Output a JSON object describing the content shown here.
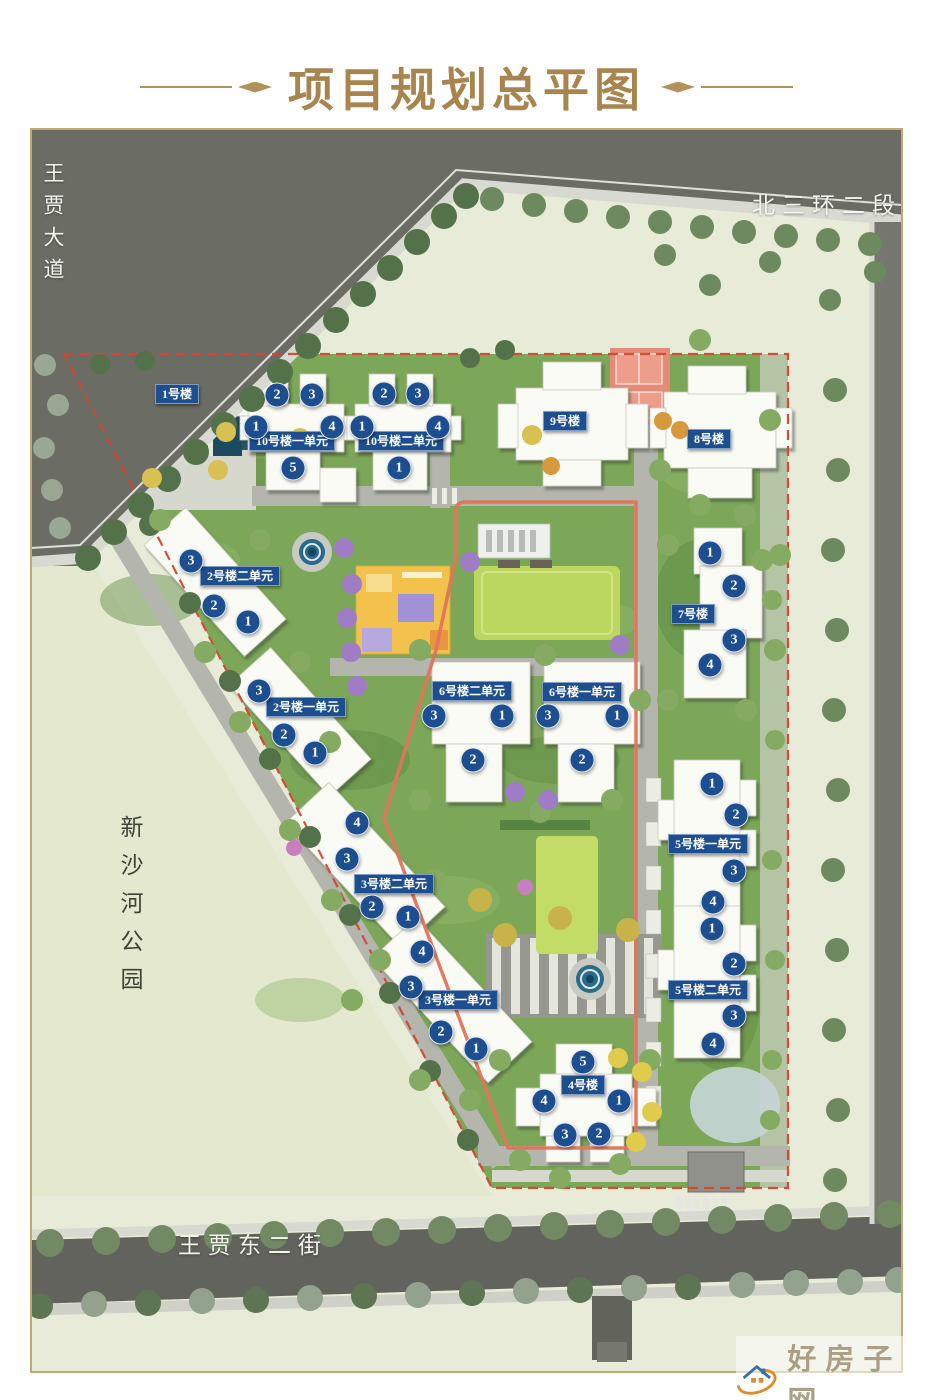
{
  "title": "项目规划总平图",
  "streets": {
    "left": "王贾大道",
    "top_right": "北三环二段",
    "bottom": "王贾东二街",
    "park": "新沙河公园"
  },
  "map": {
    "buildings": [
      {
        "label": "1号楼",
        "x": 177,
        "y": 394,
        "units": []
      },
      {
        "label": "10号楼一单元",
        "x": 292,
        "y": 441,
        "units": [
          {
            "n": "2",
            "x": 277,
            "y": 395
          },
          {
            "n": "3",
            "x": 312,
            "y": 395
          },
          {
            "n": "1",
            "x": 256,
            "y": 427
          },
          {
            "n": "4",
            "x": 332,
            "y": 427
          },
          {
            "n": "5",
            "x": 293,
            "y": 468
          }
        ]
      },
      {
        "label": "10号楼二单元",
        "x": 401,
        "y": 441,
        "units": [
          {
            "n": "2",
            "x": 384,
            "y": 394
          },
          {
            "n": "3",
            "x": 418,
            "y": 394
          },
          {
            "n": "1",
            "x": 362,
            "y": 427
          },
          {
            "n": "4",
            "x": 438,
            "y": 427
          },
          {
            "n": "1",
            "x": 399,
            "y": 468
          }
        ]
      },
      {
        "label": "9号楼",
        "x": 565,
        "y": 421,
        "units": []
      },
      {
        "label": "8号楼",
        "x": 709,
        "y": 439,
        "units": []
      },
      {
        "label": "2号楼二单元",
        "x": 240,
        "y": 576,
        "units": [
          {
            "n": "3",
            "x": 191,
            "y": 561
          },
          {
            "n": "2",
            "x": 214,
            "y": 606
          },
          {
            "n": "1",
            "x": 248,
            "y": 622
          }
        ]
      },
      {
        "label": "2号楼一单元",
        "x": 306,
        "y": 707,
        "units": [
          {
            "n": "3",
            "x": 259,
            "y": 691
          },
          {
            "n": "2",
            "x": 284,
            "y": 735
          },
          {
            "n": "1",
            "x": 315,
            "y": 753
          }
        ]
      },
      {
        "label": "6号楼二单元",
        "x": 472,
        "y": 691,
        "units": [
          {
            "n": "3",
            "x": 434,
            "y": 716
          },
          {
            "n": "1",
            "x": 502,
            "y": 716
          },
          {
            "n": "2",
            "x": 473,
            "y": 760
          }
        ]
      },
      {
        "label": "6号楼一单元",
        "x": 582,
        "y": 692,
        "units": [
          {
            "n": "3",
            "x": 548,
            "y": 716
          },
          {
            "n": "1",
            "x": 617,
            "y": 716
          },
          {
            "n": "2",
            "x": 582,
            "y": 760
          }
        ]
      },
      {
        "label": "7号楼",
        "x": 693,
        "y": 614,
        "units": [
          {
            "n": "1",
            "x": 710,
            "y": 553
          },
          {
            "n": "2",
            "x": 734,
            "y": 586
          },
          {
            "n": "3",
            "x": 734,
            "y": 640
          },
          {
            "n": "4",
            "x": 710,
            "y": 665
          }
        ]
      },
      {
        "label": "3号楼二单元",
        "x": 394,
        "y": 884,
        "units": [
          {
            "n": "4",
            "x": 357,
            "y": 823
          },
          {
            "n": "3",
            "x": 347,
            "y": 859
          },
          {
            "n": "2",
            "x": 372,
            "y": 907
          },
          {
            "n": "1",
            "x": 408,
            "y": 917
          }
        ]
      },
      {
        "label": "3号楼一单元",
        "x": 458,
        "y": 1000,
        "units": [
          {
            "n": "4",
            "x": 422,
            "y": 952
          },
          {
            "n": "3",
            "x": 411,
            "y": 987
          },
          {
            "n": "2",
            "x": 441,
            "y": 1032
          },
          {
            "n": "1",
            "x": 476,
            "y": 1049
          }
        ]
      },
      {
        "label": "5号楼一单元",
        "x": 708,
        "y": 844,
        "units": [
          {
            "n": "1",
            "x": 712,
            "y": 784
          },
          {
            "n": "2",
            "x": 736,
            "y": 815
          },
          {
            "n": "3",
            "x": 734,
            "y": 871
          },
          {
            "n": "4",
            "x": 713,
            "y": 902
          }
        ]
      },
      {
        "label": "5号楼二单元",
        "x": 708,
        "y": 990,
        "units": [
          {
            "n": "1",
            "x": 712,
            "y": 929
          },
          {
            "n": "2",
            "x": 734,
            "y": 964
          },
          {
            "n": "3",
            "x": 734,
            "y": 1016
          },
          {
            "n": "4",
            "x": 713,
            "y": 1044
          }
        ]
      },
      {
        "label": "4号楼",
        "x": 583,
        "y": 1085,
        "units": [
          {
            "n": "5",
            "x": 583,
            "y": 1062
          },
          {
            "n": "4",
            "x": 544,
            "y": 1101
          },
          {
            "n": "1",
            "x": 619,
            "y": 1101
          },
          {
            "n": "3",
            "x": 565,
            "y": 1135
          },
          {
            "n": "2",
            "x": 599,
            "y": 1134
          }
        ]
      }
    ]
  },
  "watermark": {
    "site_name": "好房子网",
    "url": "www.hfangziwang.com"
  },
  "colors": {
    "title_gold": "#a8854e",
    "label_blue": "#1d4e8f",
    "boundary_red": "#d6452f",
    "track_orange": "#e2745b",
    "road_gray": "#6b6c64",
    "site_green": "#7ca758",
    "watermark_red": "#b23a2b"
  }
}
